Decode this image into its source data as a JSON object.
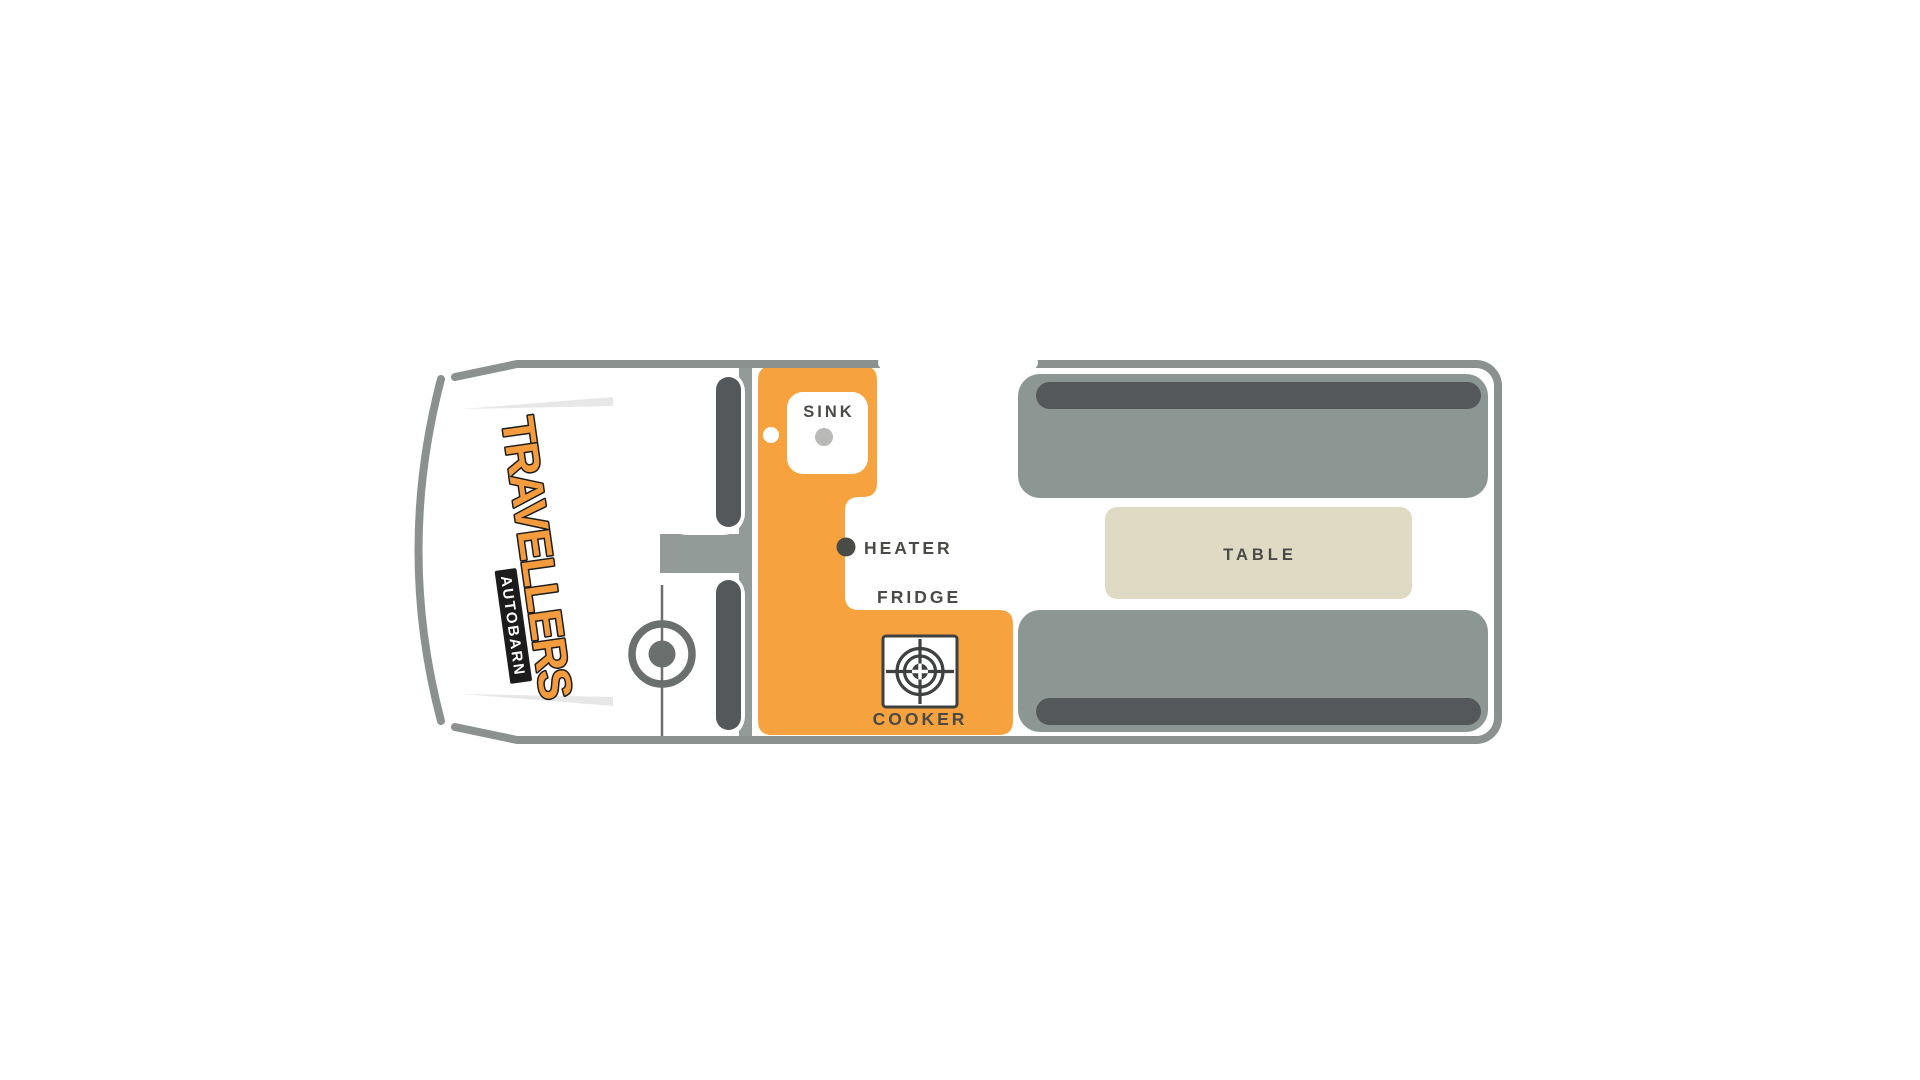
{
  "background": "#FFFFFF",
  "floorplan": {
    "brand": {
      "primary": "TRAVELLERS",
      "secondary": "AUTOBARN"
    },
    "areas": {
      "sink_label": "SINK",
      "heater_label": "HEATER",
      "fridge_label": "FRIDGE",
      "cooker_label": "COOKER",
      "table_label": "TABLE"
    },
    "icons": {
      "steering_wheel": "ring-with-center-dot",
      "cooker_burner": "gas-burner-crosshair",
      "heater": "small-dark-dot",
      "sink_tap": "small-white-dot",
      "sink_drain": "small-gray-dot"
    },
    "colors": {
      "accent_orange": "#F5A23F",
      "outline_gray": "#8A918E",
      "divider_gray": "#939B98",
      "bench_gray": "#8C9793",
      "cushion_dark": "#54585A",
      "table_beige": "#DFDAC4",
      "text_dark": "#4A4A47",
      "logo_orange": "#F49C3D",
      "steering_gray": "#6B6F6E",
      "streak_gray": "#E7E7E7",
      "drain_gray": "#B9B9B7"
    }
  }
}
